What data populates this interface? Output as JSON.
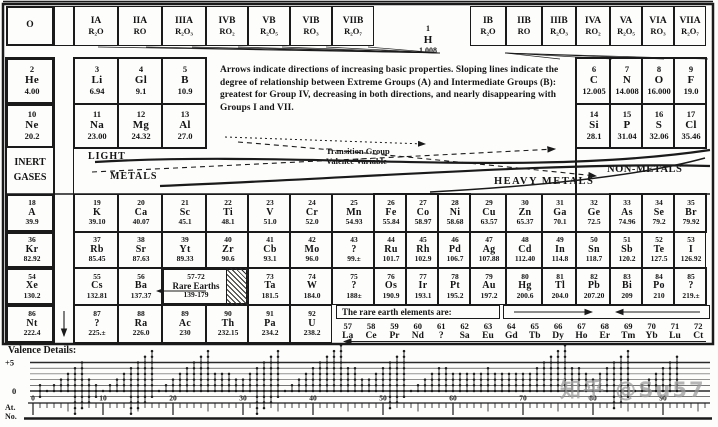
{
  "note": "Arrows indicate directions of increasing  basic  properties. Sloping lines indicate the degree of relationship between Extreme Groups (A) and Intermediate Groups (B): greatest for Group IV, decreasing in both directions, and nearly disappearing with Groups I and VII.",
  "header": {
    "groups_left": [
      {
        "label": "O",
        "oxide": ""
      },
      {
        "label": "IA",
        "oxide": "R₂O"
      },
      {
        "label": "IIA",
        "oxide": "RO"
      },
      {
        "label": "IIIA",
        "oxide": "R₂O₃"
      },
      {
        "label": "IVB",
        "oxide": "RO₂"
      },
      {
        "label": "VB",
        "oxide": "R₂O₅"
      },
      {
        "label": "VIB",
        "oxide": "RO₃"
      },
      {
        "label": "VIIB",
        "oxide": "R₂O₇"
      }
    ],
    "groups_right": [
      {
        "label": "IB",
        "oxide": "R₂O"
      },
      {
        "label": "IIB",
        "oxide": "RO"
      },
      {
        "label": "IIIB",
        "oxide": "R₂O₃"
      },
      {
        "label": "IVA",
        "oxide": "RO₂"
      },
      {
        "label": "VA",
        "oxide": "R₂O₅"
      },
      {
        "label": "VIA",
        "oxide": "RO₃"
      },
      {
        "label": "VIIA",
        "oxide": "R₂O₇"
      }
    ]
  },
  "hydrogen": {
    "number": "1",
    "symbol": "H",
    "weight": "1.008"
  },
  "band_labels": {
    "inert_gases": [
      "INERT",
      "GASES"
    ],
    "light": "LIGHT",
    "metals": "METALS",
    "transition": [
      "Transition Group",
      "Valence Variable"
    ],
    "heavy_metals": "HEAVY METALS",
    "non_metals": "NON-METALS"
  },
  "elements": [
    {
      "r": "r2",
      "c": "O",
      "n": "2",
      "s": "He",
      "w": "4.00",
      "big": true,
      "thick": true
    },
    {
      "r": "r2",
      "c": "IA",
      "n": "3",
      "s": "Li",
      "w": "6.94",
      "big": true
    },
    {
      "r": "r2",
      "c": "IIA",
      "n": "4",
      "s": "Gl",
      "w": "9.1",
      "big": true
    },
    {
      "r": "r2",
      "c": "IIIA",
      "n": "5",
      "s": "B",
      "w": "10.9",
      "big": true
    },
    {
      "r": "r2",
      "c": "IVA",
      "n": "6",
      "s": "C",
      "w": "12.005",
      "big": true
    },
    {
      "r": "r2",
      "c": "VA",
      "n": "7",
      "s": "N",
      "w": "14.008",
      "big": true
    },
    {
      "r": "r2",
      "c": "VIA",
      "n": "8",
      "s": "O",
      "w": "16.000",
      "big": true
    },
    {
      "r": "r2",
      "c": "VIIA",
      "n": "9",
      "s": "F",
      "w": "19.0",
      "big": true
    },
    {
      "r": "r3",
      "c": "O",
      "n": "10",
      "s": "Ne",
      "w": "20.2",
      "big": true,
      "thick": true
    },
    {
      "r": "r3",
      "c": "IA",
      "n": "11",
      "s": "Na",
      "w": "23.00",
      "big": true
    },
    {
      "r": "r3",
      "c": "IIA",
      "n": "12",
      "s": "Mg",
      "w": "24.32",
      "big": true
    },
    {
      "r": "r3",
      "c": "IIIA",
      "n": "13",
      "s": "Al",
      "w": "27.0",
      "big": true
    },
    {
      "r": "r3",
      "c": "IVA",
      "n": "14",
      "s": "Si",
      "w": "28.1",
      "big": true
    },
    {
      "r": "r3",
      "c": "VA",
      "n": "15",
      "s": "P",
      "w": "31.04",
      "big": true
    },
    {
      "r": "r3",
      "c": "VIA",
      "n": "16",
      "s": "S",
      "w": "32.06",
      "big": true
    },
    {
      "r": "r3",
      "c": "VIIA",
      "n": "17",
      "s": "Cl",
      "w": "35.46",
      "big": true
    },
    {
      "r": "r4",
      "c": "O",
      "n": "18",
      "s": "A",
      "w": "39.9",
      "thick": true
    },
    {
      "r": "r4",
      "c": "IA",
      "n": "19",
      "s": "K",
      "w": "39.10"
    },
    {
      "r": "r4",
      "c": "IIA",
      "n": "20",
      "s": "Ca",
      "w": "40.07"
    },
    {
      "r": "r4",
      "c": "IIIA",
      "n": "21",
      "s": "Sc",
      "w": "45.1"
    },
    {
      "r": "r4",
      "c": "IVB",
      "n": "22",
      "s": "Ti",
      "w": "48.1"
    },
    {
      "r": "r4",
      "c": "VB",
      "n": "23",
      "s": "V",
      "w": "51.0"
    },
    {
      "r": "r4",
      "c": "VIB",
      "n": "24",
      "s": "Cr",
      "w": "52.0"
    },
    {
      "r": "r4",
      "c": "VIIB",
      "n": "25",
      "s": "Mn",
      "w": "54.93"
    },
    {
      "r": "r4",
      "c": "V81",
      "n": "26",
      "s": "Fe",
      "w": "55.84"
    },
    {
      "r": "r4",
      "c": "V82",
      "n": "27",
      "s": "Co",
      "w": "58.97"
    },
    {
      "r": "r4",
      "c": "V83",
      "n": "28",
      "s": "Ni",
      "w": "58.68"
    },
    {
      "r": "r4",
      "c": "IB",
      "n": "29",
      "s": "Cu",
      "w": "63.57"
    },
    {
      "r": "r4",
      "c": "IIB",
      "n": "30",
      "s": "Zn",
      "w": "65.37"
    },
    {
      "r": "r4",
      "c": "IIIB",
      "n": "31",
      "s": "Ga",
      "w": "70.1"
    },
    {
      "r": "r4",
      "c": "IVA",
      "n": "32",
      "s": "Ge",
      "w": "72.5"
    },
    {
      "r": "r4",
      "c": "VA",
      "n": "33",
      "s": "As",
      "w": "74.96"
    },
    {
      "r": "r4",
      "c": "VIA",
      "n": "34",
      "s": "Se",
      "w": "79.2"
    },
    {
      "r": "r4",
      "c": "VIIA",
      "n": "35",
      "s": "Br",
      "w": "79.92"
    },
    {
      "r": "r5",
      "c": "O",
      "n": "36",
      "s": "Kr",
      "w": "82.92",
      "thick": true
    },
    {
      "r": "r5",
      "c": "IA",
      "n": "37",
      "s": "Rb",
      "w": "85.45"
    },
    {
      "r": "r5",
      "c": "IIA",
      "n": "38",
      "s": "Sr",
      "w": "87.63"
    },
    {
      "r": "r5",
      "c": "IIIA",
      "n": "39",
      "s": "Yt",
      "w": "89.33"
    },
    {
      "r": "r5",
      "c": "IVB",
      "n": "40",
      "s": "Zr",
      "w": "90.6"
    },
    {
      "r": "r5",
      "c": "VB",
      "n": "41",
      "s": "Cb",
      "w": "93.1"
    },
    {
      "r": "r5",
      "c": "VIB",
      "n": "42",
      "s": "Mo",
      "w": "96.0"
    },
    {
      "r": "r5",
      "c": "VIIB",
      "n": "43",
      "s": "?",
      "w": "99.±"
    },
    {
      "r": "r5",
      "c": "V81",
      "n": "44",
      "s": "Ru",
      "w": "101.7"
    },
    {
      "r": "r5",
      "c": "V82",
      "n": "45",
      "s": "Rh",
      "w": "102.9"
    },
    {
      "r": "r5",
      "c": "V83",
      "n": "46",
      "s": "Pd",
      "w": "106.7"
    },
    {
      "r": "r5",
      "c": "IB",
      "n": "47",
      "s": "Ag",
      "w": "107.88"
    },
    {
      "r": "r5",
      "c": "IIB",
      "n": "48",
      "s": "Cd",
      "w": "112.40"
    },
    {
      "r": "r5",
      "c": "IIIB",
      "n": "49",
      "s": "In",
      "w": "114.8"
    },
    {
      "r": "r5",
      "c": "IVA",
      "n": "50",
      "s": "Sn",
      "w": "118.7"
    },
    {
      "r": "r5",
      "c": "VA",
      "n": "51",
      "s": "Sb",
      "w": "120.2"
    },
    {
      "r": "r5",
      "c": "VIA",
      "n": "52",
      "s": "Te",
      "w": "127.5"
    },
    {
      "r": "r5",
      "c": "VIIA",
      "n": "53",
      "s": "I",
      "w": "126.92"
    },
    {
      "r": "r6",
      "c": "O",
      "n": "54",
      "s": "Xe",
      "w": "130.2",
      "thick": true
    },
    {
      "r": "r6",
      "c": "IA",
      "n": "55",
      "s": "Cs",
      "w": "132.81"
    },
    {
      "r": "r6",
      "c": "IIA",
      "n": "56",
      "s": "Ba",
      "w": "137.37"
    },
    {
      "r": "r6",
      "c": "IIIA",
      "c2": "IVB",
      "n": "57-72",
      "s": "Rare Earths",
      "w": "139-179",
      "hatch": true,
      "thick": true
    },
    {
      "r": "r6",
      "c": "VB",
      "n": "73",
      "s": "Ta",
      "w": "181.5"
    },
    {
      "r": "r6",
      "c": "VIB",
      "n": "74",
      "s": "W",
      "w": "184.0"
    },
    {
      "r": "r6",
      "c": "VIIB",
      "n": "75",
      "s": "?",
      "w": "188±"
    },
    {
      "r": "r6",
      "c": "V81",
      "n": "76",
      "s": "Os",
      "w": "190.9"
    },
    {
      "r": "r6",
      "c": "V82",
      "n": "77",
      "s": "Ir",
      "w": "193.1"
    },
    {
      "r": "r6",
      "c": "V83",
      "n": "78",
      "s": "Pt",
      "w": "195.2"
    },
    {
      "r": "r6",
      "c": "IB",
      "n": "79",
      "s": "Au",
      "w": "197.2"
    },
    {
      "r": "r6",
      "c": "IIB",
      "n": "80",
      "s": "Hg",
      "w": "200.6"
    },
    {
      "r": "r6",
      "c": "IIIB",
      "n": "81",
      "s": "Tl",
      "w": "204.0"
    },
    {
      "r": "r6",
      "c": "IVA",
      "n": "82",
      "s": "Pb",
      "w": "207.20"
    },
    {
      "r": "r6",
      "c": "VA",
      "n": "83",
      "s": "Bi",
      "w": "209"
    },
    {
      "r": "r6",
      "c": "VIA",
      "n": "84",
      "s": "Po",
      "w": "210"
    },
    {
      "r": "r6",
      "c": "VIIA",
      "n": "85",
      "s": "?",
      "w": "219.±"
    },
    {
      "r": "r7",
      "c": "O",
      "n": "86",
      "s": "Nt",
      "w": "222.4",
      "thick": true
    },
    {
      "r": "r7",
      "c": "IA",
      "n": "87",
      "s": "?",
      "w": "225.±"
    },
    {
      "r": "r7",
      "c": "IIA",
      "n": "88",
      "s": "Ra",
      "w": "226.0"
    },
    {
      "r": "r7",
      "c": "IIIA",
      "n": "89",
      "s": "Ac",
      "w": "230"
    },
    {
      "r": "r7",
      "c": "IVB",
      "n": "90",
      "s": "Th",
      "w": "232.15"
    },
    {
      "r": "r7",
      "c": "VB",
      "n": "91",
      "s": "Pa",
      "w": "234.2"
    },
    {
      "r": "r7",
      "c": "VIB",
      "n": "92",
      "s": "U",
      "w": "238.2"
    }
  ],
  "rare_earths": {
    "title": "The rare earth elements are:",
    "items": [
      {
        "n": "57",
        "s": "La"
      },
      {
        "n": "58",
        "s": "Ce"
      },
      {
        "n": "59",
        "s": "Pr"
      },
      {
        "n": "60",
        "s": "Nd"
      },
      {
        "n": "61",
        "s": "?"
      },
      {
        "n": "62",
        "s": "Sa"
      },
      {
        "n": "63",
        "s": "Eu"
      },
      {
        "n": "64",
        "s": "Gd"
      },
      {
        "n": "65",
        "s": "Tb"
      },
      {
        "n": "66",
        "s": "Dy"
      },
      {
        "n": "67",
        "s": "Ho"
      },
      {
        "n": "68",
        "s": "Er"
      },
      {
        "n": "69",
        "s": "Tm"
      },
      {
        "n": "70",
        "s": "Yb"
      },
      {
        "n": "71",
        "s": "Lu"
      },
      {
        "n": "72",
        "s": "Ct"
      }
    ]
  },
  "watermark": "知乎 @Su57",
  "chart_data": {
    "type": "scatter",
    "title": "Valence Details:",
    "xlabel": "At. No.",
    "xlabel_lines": [
      "At.",
      "No."
    ],
    "y_axis_labels": {
      "top": "+5",
      "zero": "0"
    },
    "x_tick_labels": [
      0,
      10,
      20,
      30,
      40,
      50,
      60,
      70,
      80,
      90
    ],
    "x_range": [
      0,
      96
    ],
    "y_range": [
      -4,
      8
    ],
    "grid": true,
    "max_valence": [
      1,
      0,
      1,
      2,
      3,
      4,
      5,
      2,
      1,
      0,
      1,
      2,
      3,
      4,
      5,
      6,
      7,
      0,
      1,
      2,
      3,
      4,
      5,
      6,
      7,
      3,
      3,
      3,
      2,
      2,
      3,
      4,
      5,
      6,
      7,
      0,
      1,
      2,
      3,
      4,
      5,
      6,
      7,
      8,
      4,
      4,
      2,
      2,
      3,
      4,
      5,
      6,
      7,
      0,
      1,
      2,
      3,
      4,
      4,
      3,
      3,
      3,
      3,
      3,
      4,
      3,
      3,
      3,
      3,
      3,
      3,
      4,
      5,
      6,
      7,
      8,
      4,
      4,
      3,
      2,
      3,
      4,
      5,
      6,
      7,
      0,
      1,
      2,
      3,
      4,
      5,
      6
    ],
    "min_valence": [
      -1,
      0,
      0,
      0,
      0,
      -4,
      -3,
      -2,
      -1,
      0,
      0,
      0,
      0,
      -4,
      -3,
      -2,
      -1,
      0,
      0,
      0,
      0,
      0,
      0,
      0,
      0,
      0,
      0,
      0,
      0,
      0,
      0,
      -4,
      -3,
      -2,
      -1,
      0,
      0,
      0,
      0,
      0,
      0,
      0,
      0,
      0,
      0,
      0,
      0,
      0,
      0,
      0,
      -3,
      -2,
      -1,
      0,
      0,
      0,
      0,
      0,
      0,
      0,
      0,
      0,
      0,
      0,
      0,
      0,
      0,
      0,
      0,
      0,
      0,
      0,
      0,
      0,
      0,
      0,
      0,
      0,
      0,
      0,
      0,
      0,
      -3,
      -2,
      -1,
      0,
      0,
      0,
      0,
      0,
      0,
      0
    ]
  }
}
